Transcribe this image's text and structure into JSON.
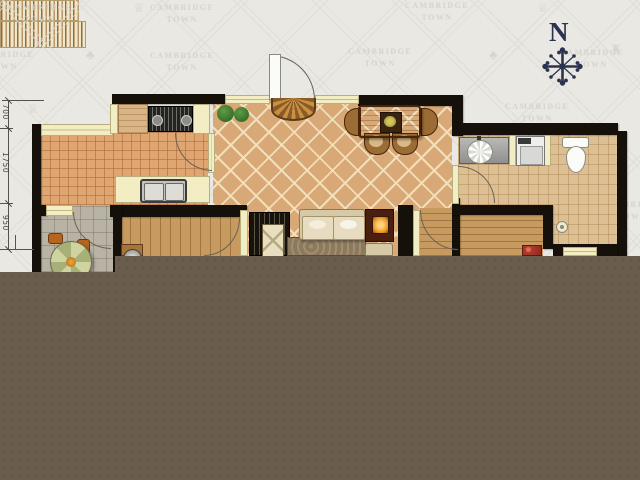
{
  "title": "apartment floor plan",
  "watermark": {
    "line1": "CAMBRIDGE",
    "line2": "TOWN"
  },
  "compass": {
    "north_label": "N"
  },
  "dimensions": [
    {
      "label": "700"
    },
    {
      "label": "1750"
    },
    {
      "label": "950"
    }
  ],
  "colors": {
    "background": "#e9e8e2",
    "lattice": "#dcdbd4",
    "watermark": "#d5d4cc",
    "wall": "#15100a",
    "cream": "#f3edc4",
    "kitchen_tile": "#dfa671",
    "living_tile": "#d8a876",
    "bath_tile": "#dcc094",
    "balcony_tile": "#b9b3a5",
    "wood_floor": "#c79a5f",
    "compass": "#2b3352",
    "unloaded": "#6b5d4e"
  }
}
